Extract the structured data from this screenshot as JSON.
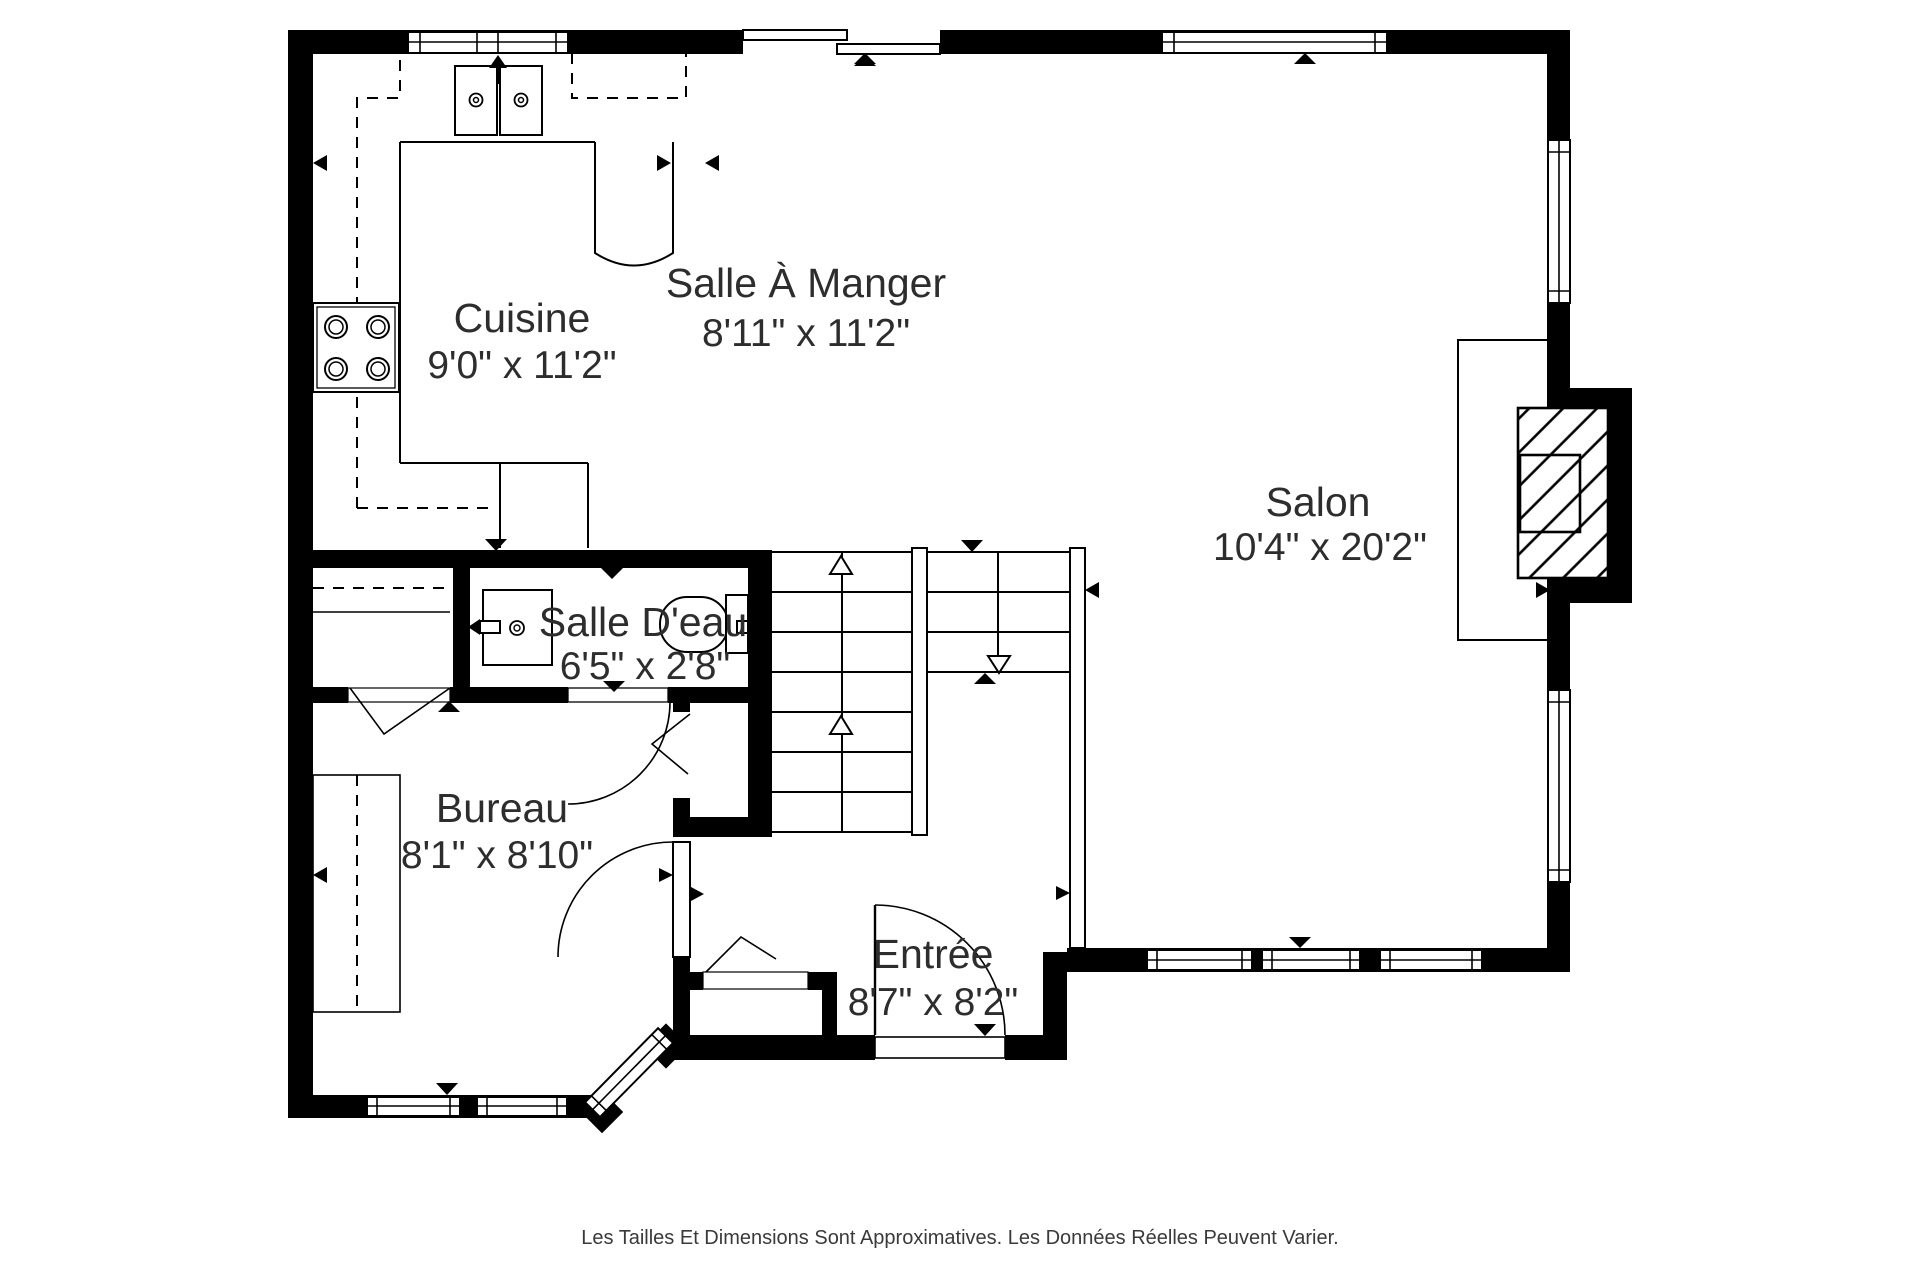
{
  "floorplan": {
    "title": "floor-plan",
    "colors": {
      "wall": "#000000",
      "background": "#ffffff",
      "text": "#2d2d2d"
    },
    "rooms": [
      {
        "name": "Cuisine",
        "dimensions": "9'0\" x 11'2\""
      },
      {
        "name": "Salle À Manger",
        "dimensions": "8'11\" x 11'2\""
      },
      {
        "name": "Salon",
        "dimensions": "10'4\" x 20'2\""
      },
      {
        "name": "Salle D'eau",
        "dimensions": "6'5\" x 2'8\""
      },
      {
        "name": "Bureau",
        "dimensions": "8'1\" x 8'10\""
      },
      {
        "name": "Entrée",
        "dimensions": "8'7\" x 8'2\""
      }
    ],
    "fixtures": [
      "double-sink",
      "stove-4-burners",
      "vanity-sink",
      "toilet",
      "fireplace",
      "staircase",
      "desk",
      "closet-bifold",
      "entry-door",
      "sliding-patio-door",
      "bay-window"
    ],
    "footer": "Les Tailles Et Dimensions Sont Approximatives. Les Données Réelles Peuvent Varier."
  }
}
